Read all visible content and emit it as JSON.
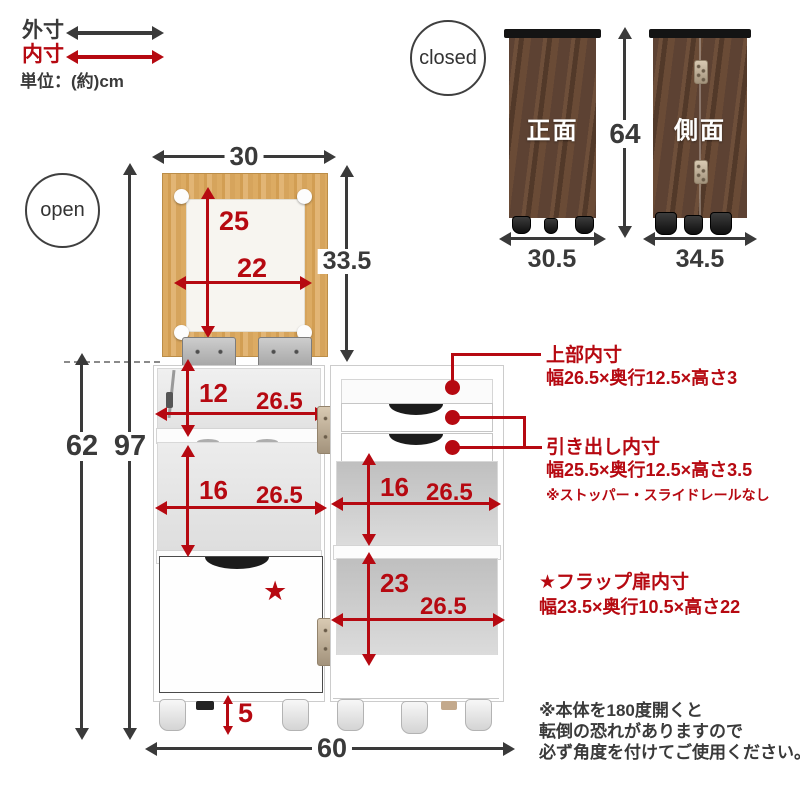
{
  "legend": {
    "outer_label": "外寸",
    "inner_label": "内寸",
    "unit_label": "単位：(約)cm"
  },
  "closed": {
    "badge": "closed",
    "front_label": "正面",
    "front_width": "30.5",
    "side_label": "側面",
    "side_width": "34.5",
    "height": "64"
  },
  "open": {
    "badge": "open",
    "flap_width": "30",
    "flap_height": "33.5",
    "flap_inner_height": "25",
    "flap_inner_width": "22",
    "left_top_height": "12",
    "left_top_width": "26.5",
    "left_mid_height": "16",
    "left_mid_width": "26.5",
    "right_shelf_height": "16",
    "right_shelf_width": "26.5",
    "right_bottom_height": "23",
    "right_bottom_width": "26.5",
    "caster_height": "5",
    "total_height": "97",
    "body_height": "62",
    "total_width": "60",
    "star": "★"
  },
  "callouts": {
    "top": {
      "title": "上部内寸",
      "dims": "幅26.5×奥行12.5×高さ3"
    },
    "drawer": {
      "title": "引き出し内寸",
      "dims": "幅25.5×奥行12.5×高さ3.5",
      "note": "※ストッパー・スライドレールなし"
    },
    "flap": {
      "title": "★フラップ扉内寸",
      "dims": "幅23.5×奥行10.5×高さ22"
    },
    "warning": {
      "line1": "※本体を180度開くと",
      "line2": "転倒の恐れがありますので",
      "line3": "必ず角度を付けてご使用ください。"
    }
  },
  "colors": {
    "accent_red": "#b60911",
    "arrow_black": "#3a3a3a"
  }
}
